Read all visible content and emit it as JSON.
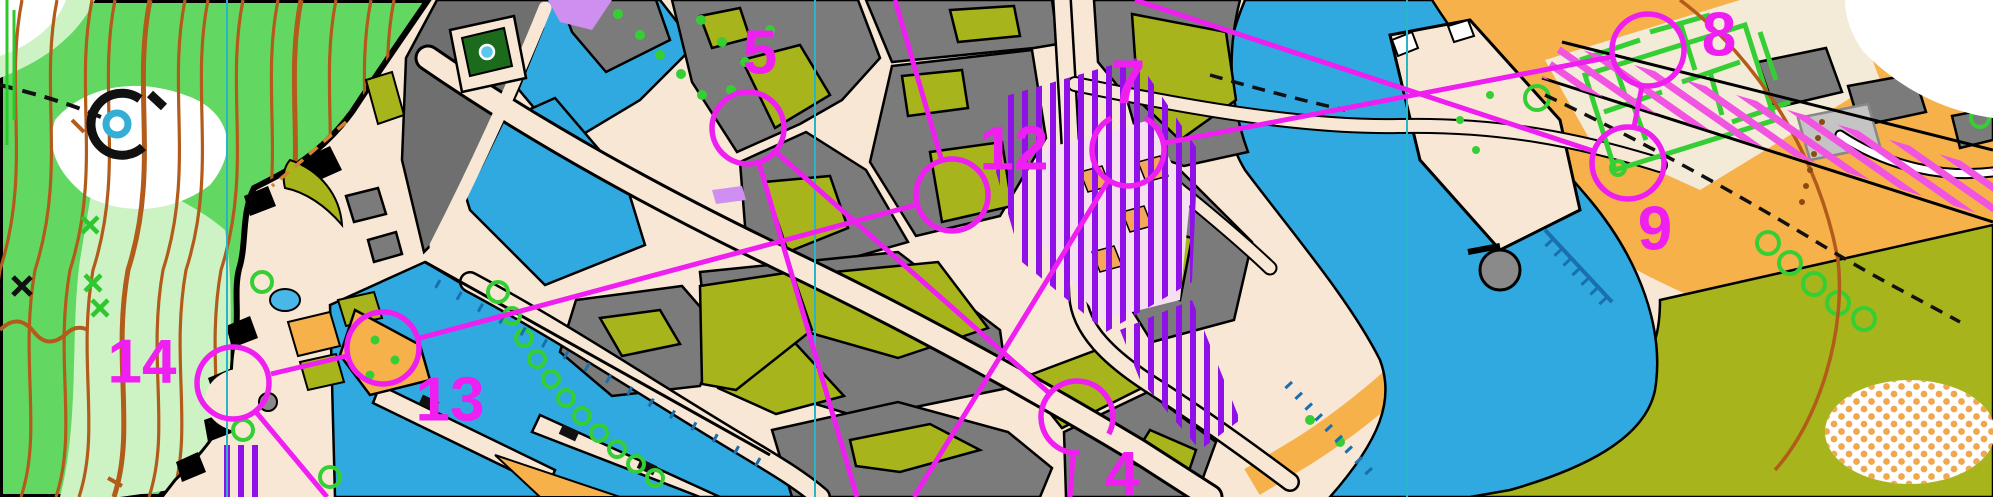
{
  "map": {
    "kind": "sprint-orienteering-map",
    "course_controls_visible": [
      "4",
      "5",
      "7",
      "8",
      "9",
      "12",
      "13",
      "14"
    ]
  },
  "course": {
    "color": "#ee1ff0",
    "circle_radius": 36,
    "line_width": 5,
    "number_font_size": 62,
    "controls": [
      {
        "number": "4",
        "cx": 1077,
        "cy": 417,
        "lx": 1122,
        "ly": 474,
        "gap_start": 28,
        "gap_end": 86
      },
      {
        "number": "5",
        "cx": 748,
        "cy": 128,
        "lx": 760,
        "ly": 53
      },
      {
        "number": "7",
        "cx": 1128,
        "cy": 150,
        "lx": 1128,
        "ly": 83,
        "gap_start": -118,
        "gap_end": -62
      },
      {
        "number": "8",
        "cx": 1648,
        "cy": 50,
        "lx": 1719,
        "ly": 35
      },
      {
        "number": "9",
        "cx": 1628,
        "cy": 163,
        "lx": 1655,
        "ly": 229
      },
      {
        "number": "12",
        "cx": 952,
        "cy": 195,
        "lx": 1014,
        "ly": 149
      },
      {
        "number": "13",
        "cx": 383,
        "cy": 348,
        "lx": 450,
        "ly": 400
      },
      {
        "number": "14",
        "cx": 233,
        "cy": 383,
        "lx": 142,
        "ly": 362
      }
    ],
    "legs": [
      {
        "x1": 1070,
        "y1": 497,
        "x2": 1073,
        "y2": 456
      },
      {
        "x1": 1048,
        "y1": 392,
        "x2": 777,
        "y2": 153
      },
      {
        "x1": 759,
        "y1": 163,
        "x2": 857,
        "y2": 497
      },
      {
        "x1": 914,
        "y1": 497,
        "x2": 1108,
        "y2": 181
      },
      {
        "x1": 1165,
        "y1": 143,
        "x2": 1611,
        "y2": 57
      },
      {
        "x1": 1642,
        "y1": 86,
        "x2": 1634,
        "y2": 127
      },
      {
        "x1": 1593,
        "y1": 151,
        "x2": 1135,
        "y2": 0
      },
      {
        "x1": 895,
        "y1": 0,
        "x2": 941,
        "y2": 158
      },
      {
        "x1": 916,
        "y1": 205,
        "x2": 420,
        "y2": 338
      },
      {
        "x1": 347,
        "y1": 356,
        "x2": 271,
        "y2": 374
      },
      {
        "x1": 256,
        "y1": 412,
        "x2": 327,
        "y2": 497
      }
    ]
  },
  "north_lines": {
    "color": "#29b5c8",
    "width": 2,
    "x_positions": [
      227,
      815,
      1407
    ]
  },
  "colors": {
    "forest_green": "#62d862",
    "light_green": "#cdf3c4",
    "white_open": "#ffffff",
    "water_blue": "#2fa9df",
    "wall_blue": "#1a6fae",
    "paved_beige": "#f8e7d4",
    "building_gray": "#7b7b7b",
    "canopy_gray": "#c4c4c4",
    "courtyard_olive": "#a7b41b",
    "open_orange": "#f6b14b",
    "oob_purple": "#9010e8",
    "oob_pink_stripe": "#f054e0",
    "lilac": "#cf8ff0",
    "contour_brown": "#b35b1a",
    "vegetation_green": "#35cf35",
    "dark_hedge_green": "#1c6b1c"
  },
  "symbols": [
    {
      "name": "well-icon"
    },
    {
      "name": "fountain-icon"
    },
    {
      "name": "distinctive-tree-icon"
    },
    {
      "name": "green-cross-icon"
    },
    {
      "name": "black-cross-icon"
    }
  ]
}
